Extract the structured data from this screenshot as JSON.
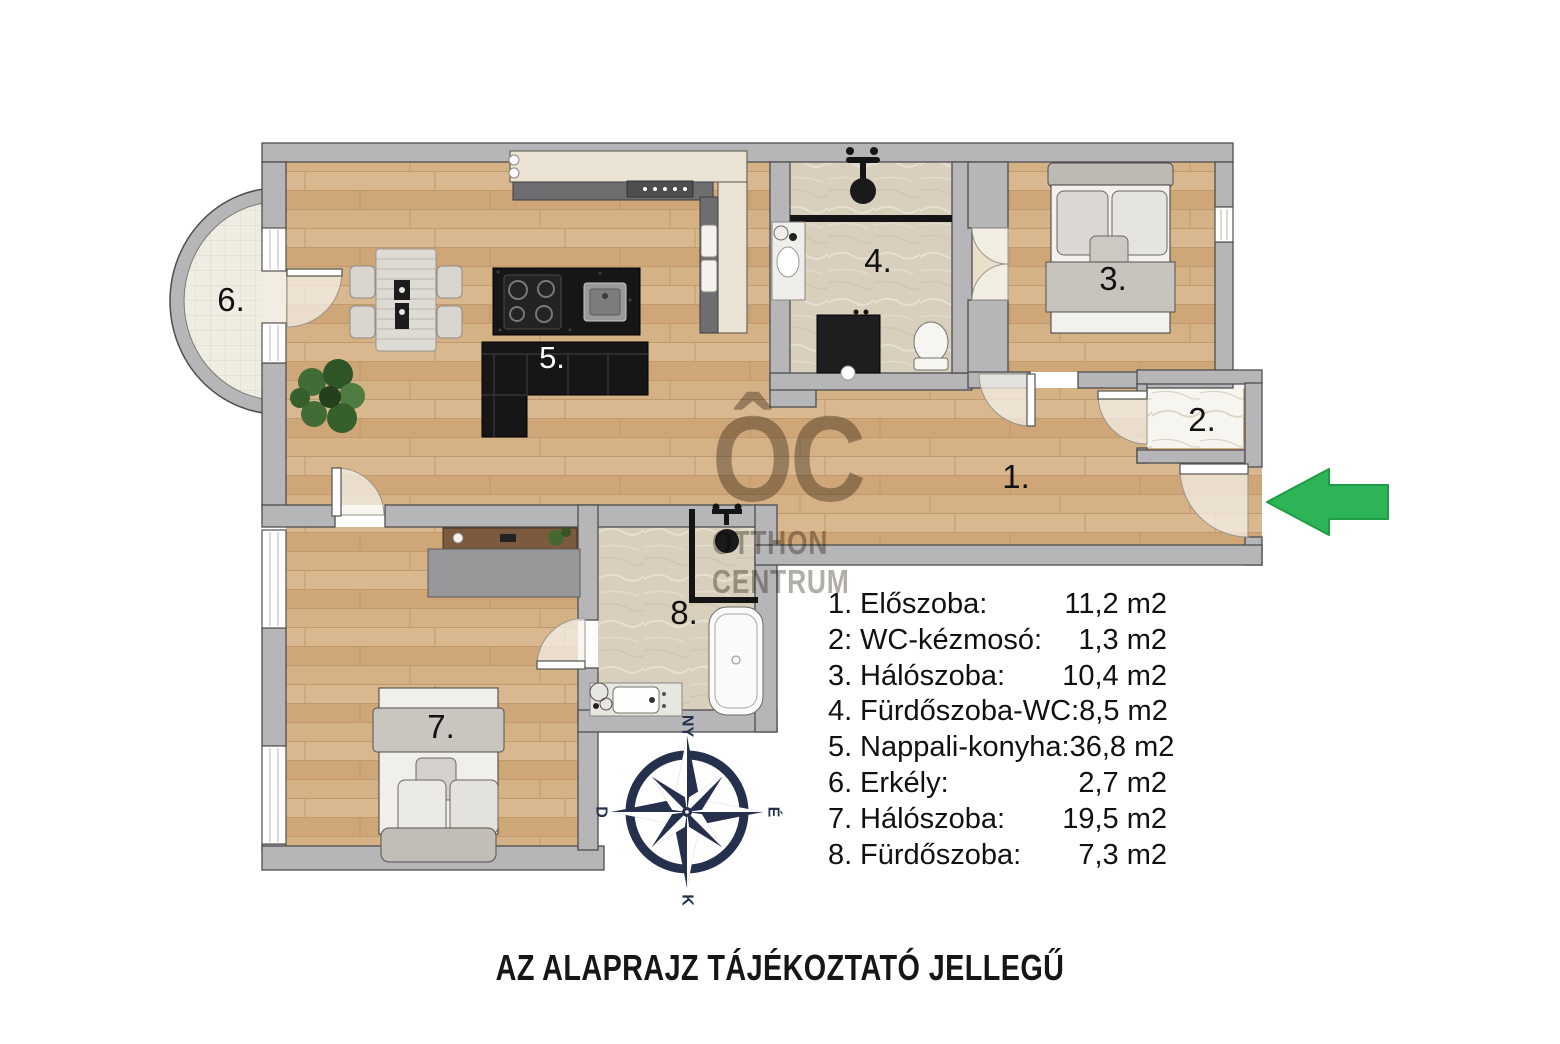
{
  "plan": {
    "room_numbers": {
      "n1": "1.",
      "n2": "2.",
      "n3": "3.",
      "n4": "4.",
      "n5": "5.",
      "n6": "6.",
      "n7": "7.",
      "n8": "8."
    },
    "compass": {
      "top": "NY",
      "right": "É",
      "bottom": "K",
      "left": "D"
    },
    "watermark": {
      "logo": "ÔC",
      "line1": "OTTHON",
      "line2": "CENTRUM"
    },
    "disclaimer": "AZ ALAPRAJZ TÁJÉKOZTATÓ JELLEGŰ",
    "legend": {
      "rows": [
        {
          "num": "1.",
          "name": "Előszoba:",
          "area": "11,2 m2"
        },
        {
          "num": "2:",
          "name": "WC-kézmosó:",
          "area": "1,3 m2"
        },
        {
          "num": "3.",
          "name": "Hálószoba:",
          "area": "10,4 m2"
        },
        {
          "num": "4.",
          "name": "Fürdőszoba-WC:",
          "area": "8,5 m2"
        },
        {
          "num": "5.",
          "name": "Nappali-konyha:",
          "area": "36,8 m2"
        },
        {
          "num": "6.",
          "name": "Erkély:",
          "area": "2,7 m2"
        },
        {
          "num": "7.",
          "name": "Hálószoba:",
          "area": "19,5 m2"
        },
        {
          "num": "8.",
          "name": "Fürdőszoba:",
          "area": "7,3 m2"
        }
      ]
    }
  },
  "colors": {
    "wall": "#b6b6b8",
    "wood": "#d3ae82",
    "arrow_green": "#2db456",
    "compass_navy": "#25304c"
  }
}
